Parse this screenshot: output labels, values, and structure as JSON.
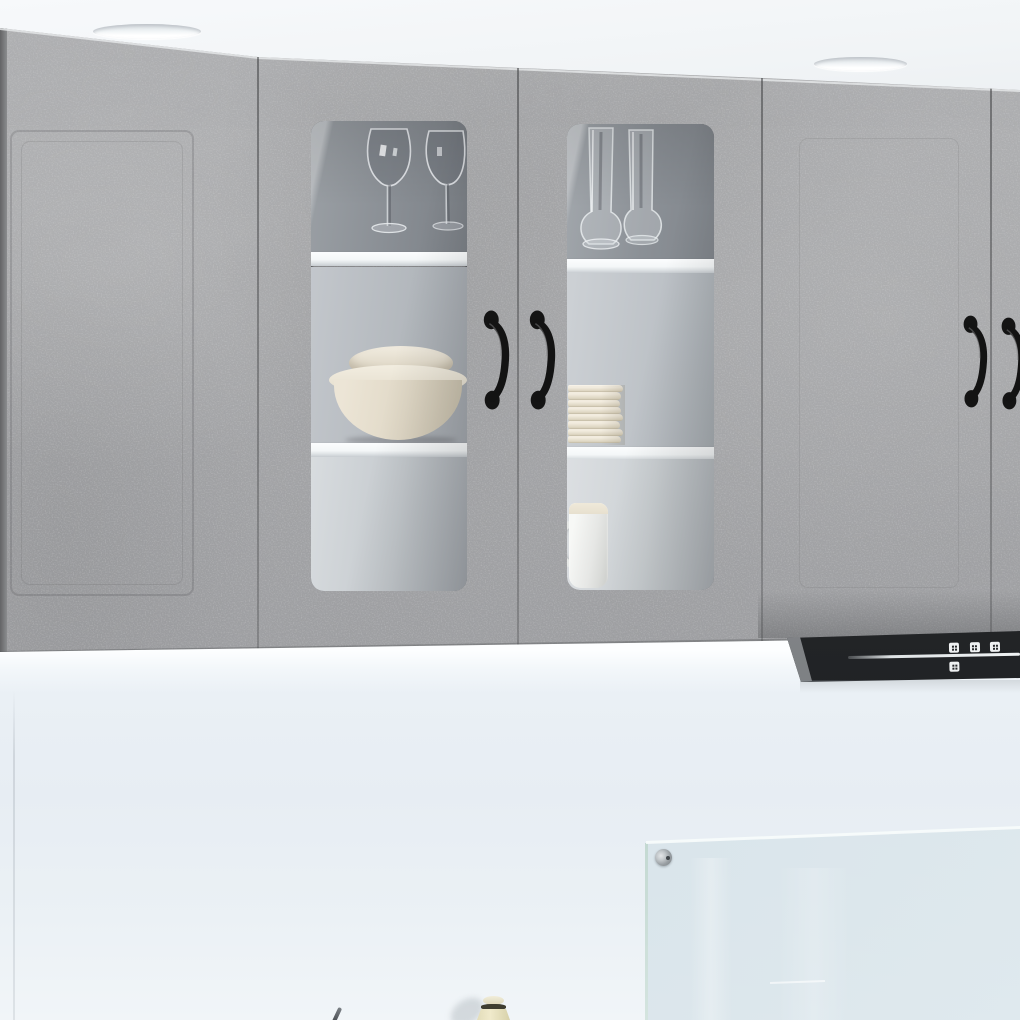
{
  "image": {
    "domain": "natural-image",
    "subject": "Concrete-grey kitchen wall cabinet set with two glass display doors, black extractor hood and glass splashback",
    "setting": "modern kitchen render, white ceiling above, pale blue-grey wall below",
    "visible_text": ""
  },
  "palette": {
    "ceiling": "#f2f5f7",
    "concrete": "#a7a8aa",
    "concrete_dark": "#8d8e90",
    "concrete_light": "#bcbdbf",
    "seam": "#77787a",
    "shelf_white": "#f4f7f8",
    "glass_tint": "#868b91",
    "handle_black": "#161616",
    "hood_black": "#26282a",
    "hood_silver_line": "#dfe3e5",
    "wall": "#e9eff4",
    "wall_bright": "#fdfeff",
    "splashback": "#d6e2e9",
    "bowl_cream": "#e7dfd0",
    "plate_cream": "#e8e1d0",
    "mug_white": "#eeefec",
    "bottle_cream": "#e6e0bf",
    "bottle_band": "#3e3d30"
  },
  "cabinets": {
    "finish": "concrete grey",
    "doors_visible": 5,
    "glass_doors": 2,
    "solid_doors": 3,
    "handle_count": 4,
    "handle_style": "black curved vertical pull with round feet",
    "shelves_per_glass_door": 2
  },
  "shelf_contents": {
    "glass_door_1": [
      "two wine glasses",
      "stacked cream bowls",
      "empty lower shelf"
    ],
    "glass_door_2": [
      "two drinking glasses",
      "stack of cream plates",
      "white mug"
    ],
    "plate_count": 8,
    "bowl_count": 2,
    "wine_glass_count": 2,
    "drinking_glass_count": 2
  },
  "hood": {
    "color": "black",
    "button_count": 4,
    "has_light_bar": true
  },
  "ceiling": {
    "recessed_light_count": 2
  },
  "splashback": {
    "type": "glass panel",
    "fixing_count": 1
  },
  "counter_items": [
    "small cream bottle with dark band",
    "utensil tip"
  ]
}
